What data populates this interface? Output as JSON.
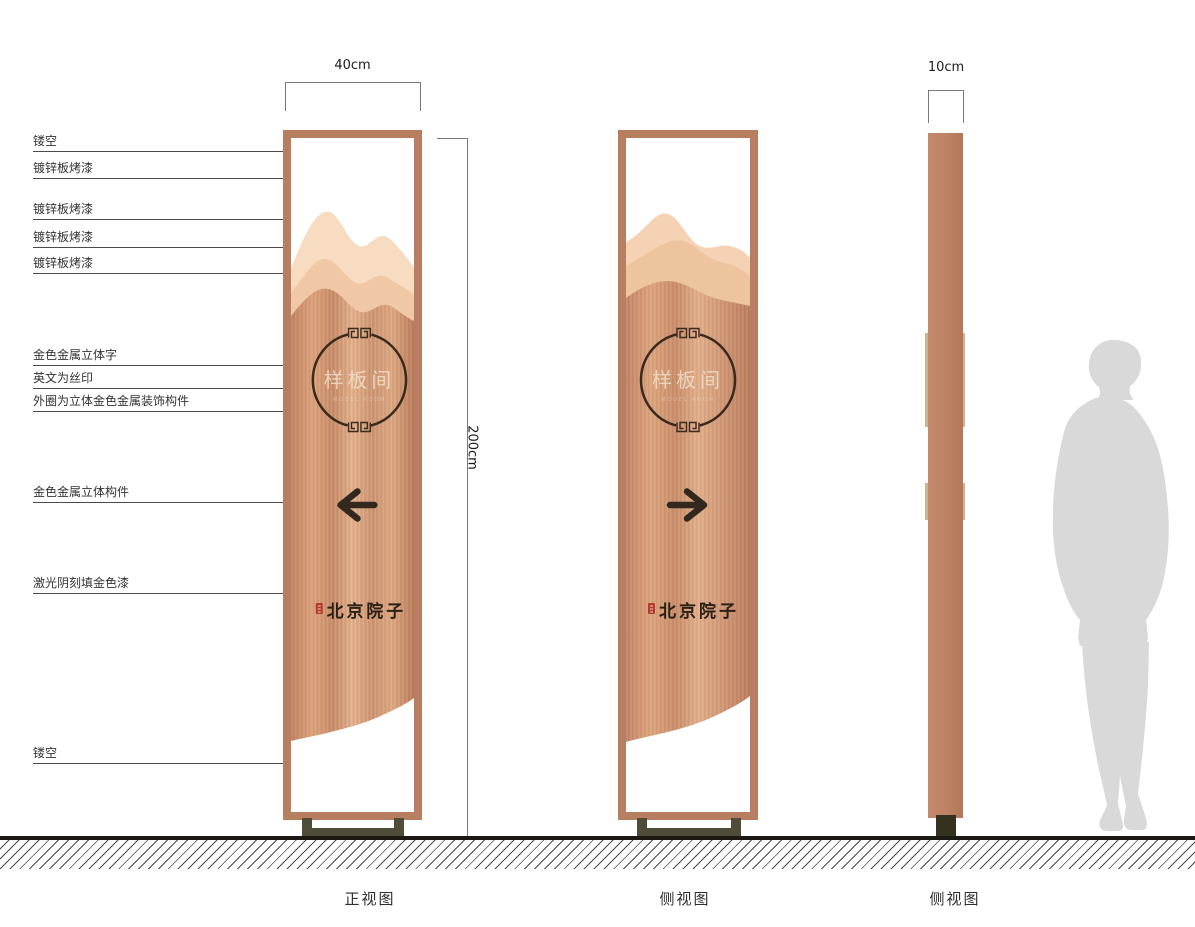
{
  "annotations": {
    "items": [
      {
        "text": "镂空"
      },
      {
        "text": "镀锌板烤漆"
      },
      {
        "text": "镀锌板烤漆"
      },
      {
        "text": "镀锌板烤漆"
      },
      {
        "text": "镀锌板烤漆"
      },
      {
        "text": "金色金属立体字"
      },
      {
        "text": "英文为丝印"
      },
      {
        "text": "外圈为立体金色金属装饰构件"
      },
      {
        "text": "金色金属立体构件"
      },
      {
        "text": "激光阴刻填金色漆"
      },
      {
        "text": "镂空"
      }
    ]
  },
  "dimensions": {
    "front_width": "40cm",
    "side_width": "10cm",
    "height": "200cm"
  },
  "sign": {
    "circle_text": "样板间",
    "circle_subtext": "MODEL ROOM",
    "logo_text": "北京院子"
  },
  "views": {
    "front": "正视图",
    "side": "侧视图",
    "side2": "侧视图"
  },
  "colors": {
    "frame": "#b87e60",
    "copper": "#c98e6c",
    "mountain_light": "#f7dcc2",
    "mountain_mid": "#f0c8a5",
    "arrow_dark": "#32281e",
    "seal_red": "#b53a2b",
    "base_olive": "#4f4c3a",
    "person_gray": "#d9d9d9"
  }
}
